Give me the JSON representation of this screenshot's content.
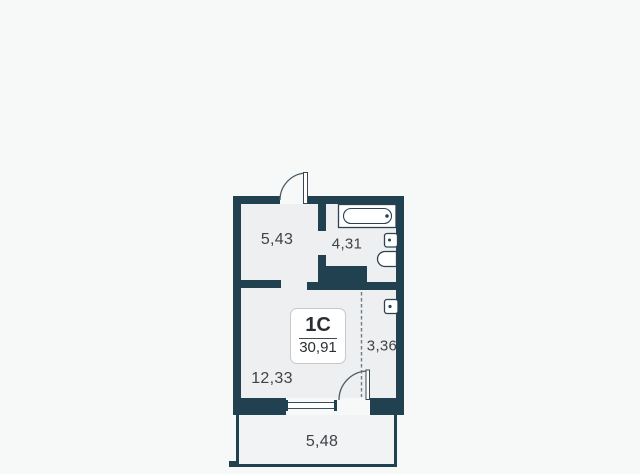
{
  "plan": {
    "unit_badge": {
      "type_label": "1C",
      "area_label": "30,91"
    },
    "rooms": [
      {
        "id": "hallway",
        "area_label": "5,43"
      },
      {
        "id": "bathroom",
        "area_label": "4,31"
      },
      {
        "id": "living-room",
        "area_label": "12,33"
      },
      {
        "id": "wardrobe-zone",
        "area_label": "3,36"
      },
      {
        "id": "balcony",
        "area_label": "5,48"
      }
    ],
    "fixtures": [
      "bathtub",
      "sink",
      "toilet",
      "washing-machine"
    ],
    "doors": [
      "entrance-door",
      "balcony-door"
    ],
    "colors": {
      "wall": "#214150",
      "room_fill": "#edeff0",
      "balcony_fill": "#f2f3f4",
      "background": "#f7f8f8",
      "label_text": "#3f4346",
      "fixture_outline": "#2c4250",
      "badge_border": "#c5c9cb"
    }
  }
}
